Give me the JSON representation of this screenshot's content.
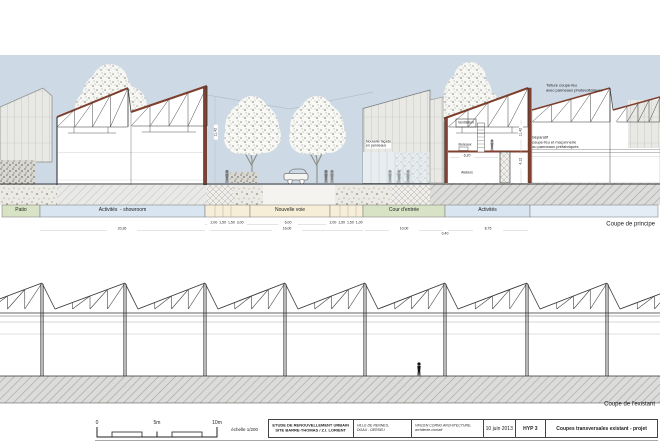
{
  "sheet": {
    "principle": {
      "caption": "Coupe de principe",
      "zones": [
        {
          "label": "Patio"
        },
        {
          "label": "Activités  - showroom"
        },
        {
          "label": "Nouvelle voie"
        },
        {
          "label": "Cour d'entrée"
        },
        {
          "label": "Activités"
        }
      ],
      "rooms": {
        "ventilation": "Ventilation",
        "bureaux": "Bureaux",
        "ateliers": "Ateliers"
      },
      "annotations": {
        "roof": "Toiture coupe-feu\navec panneaux photovoltaïques",
        "wall": "Séparatif\ncoupe-feu et maçonnerie\nou panneaux préfabriqués",
        "facade": "Nouvelle façade\nen panneaux"
      },
      "dimensions": {
        "showroom_total": "20,26",
        "left_cluster": "2,00  1,50  1,50  3,00",
        "voie_width": "6,00",
        "right_cluster": "2,00  1,50  1,50  1,00",
        "voie_total": "16,00",
        "cour_total": "10,00",
        "gap": "0,40",
        "activites_total": "8,75",
        "height_left": "11,42",
        "height_right": "11,42",
        "mezzanine_height": "4,12",
        "ateliers_width": "6,20"
      }
    },
    "existing": {
      "caption": "Coupe de l'existant"
    },
    "footer": {
      "scalebar": {
        "zero": "0",
        "five": "5m",
        "ten": "10m",
        "scale_label": "échelle 1/200"
      },
      "titleblock": {
        "project": "ETUDE DE RENOUVELLEMENT URBAIN\nSITE BARRE-THOMAS / Z.I. LORIENT",
        "client": "VILLE DE RENNES,\nDGAU - DERSEU",
        "architect": "VINCEN CORNU ARCHITECTURE,\narchitecte-conseil",
        "date": "10 juin 2013",
        "hypothesis": "HYP 3",
        "drawing_title": "Coupes transversales existant - projet"
      }
    },
    "colors": {
      "sky": "#cdd9e5",
      "roof_accent": "#7f3e2c",
      "zone_green": "#d8e2c4",
      "zone_blue": "#d9e5f1",
      "zone_cream": "#f6eed6",
      "hatch_grey": "#dcdcda"
    }
  }
}
